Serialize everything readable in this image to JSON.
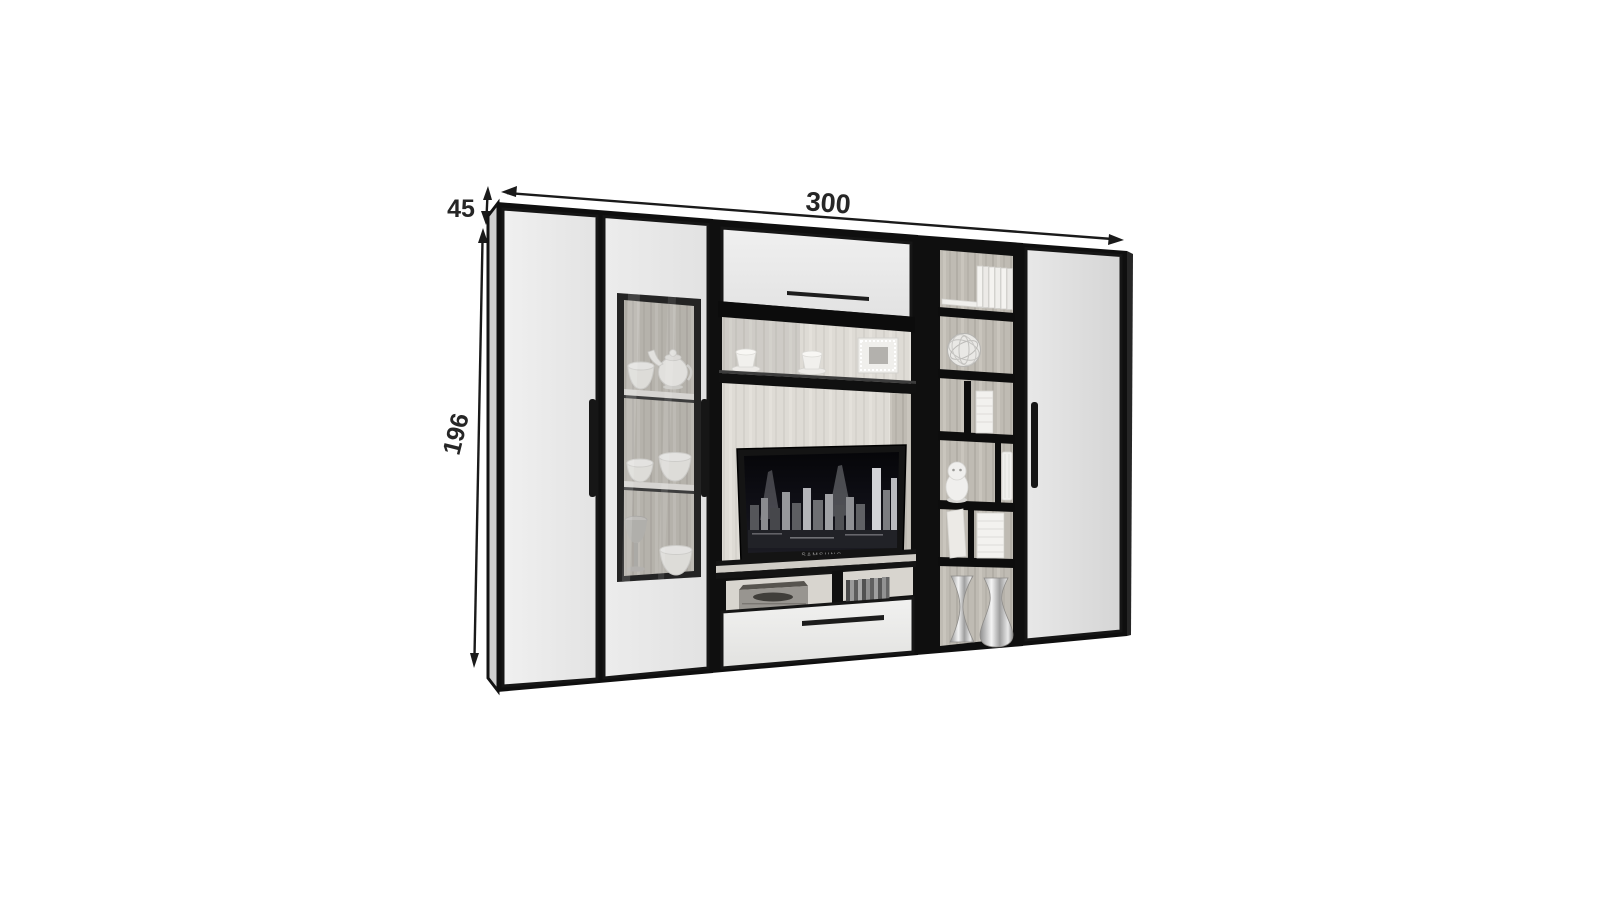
{
  "dimensions": {
    "width": "300",
    "height": "196",
    "depth": "45"
  },
  "tv": {
    "brand_label": "SAMSUNG"
  },
  "colors": {
    "background": "#ffffff",
    "outline": "#131313",
    "door_face_light": "#ededed",
    "door_face_dark": "#dcdcdc",
    "wood_mid": "#bfbbb3",
    "wood_light": "#dcd9d3",
    "screen_dark": "#07070c",
    "dimension_text": "#262626"
  }
}
